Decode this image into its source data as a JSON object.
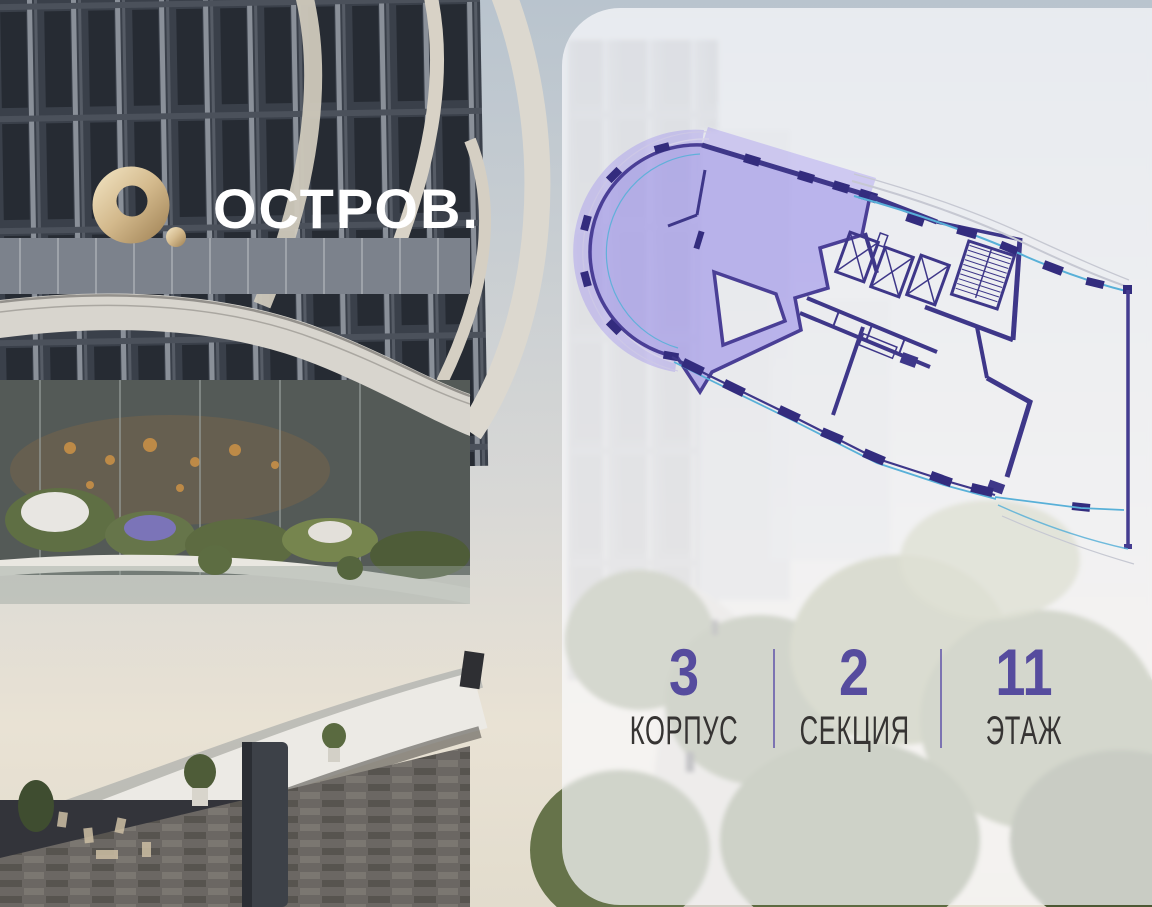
{
  "brand": {
    "name": "ОСТРОВ.",
    "mark": "gold-ring-with-dot",
    "mark_color": "#d3b98c",
    "name_color": "#ffffff"
  },
  "floor_plan": {
    "kind": "building-floor-plan",
    "selected_unit_fill": "#8a7ae0",
    "selected_unit_outline": "#4a3f96",
    "wall_color": "#3e3789",
    "glazing_line_color": "#58b0d8",
    "balcony_line_color": "#c6c8d2",
    "features": [
      "selected-apartment",
      "balcony-band",
      "elevator-shafts",
      "staircase",
      "corridor",
      "terrace-edge"
    ]
  },
  "selection": {
    "items": [
      {
        "id": "korpus",
        "value": "3",
        "label": "КОРПУС"
      },
      {
        "id": "sekcia",
        "value": "2",
        "label": "СЕКЦИЯ"
      },
      {
        "id": "etazh",
        "value": "11",
        "label": "ЭТАЖ"
      }
    ],
    "value_color": "#564c9e",
    "label_color": "#363433",
    "divider_color": "#6d62ae"
  }
}
